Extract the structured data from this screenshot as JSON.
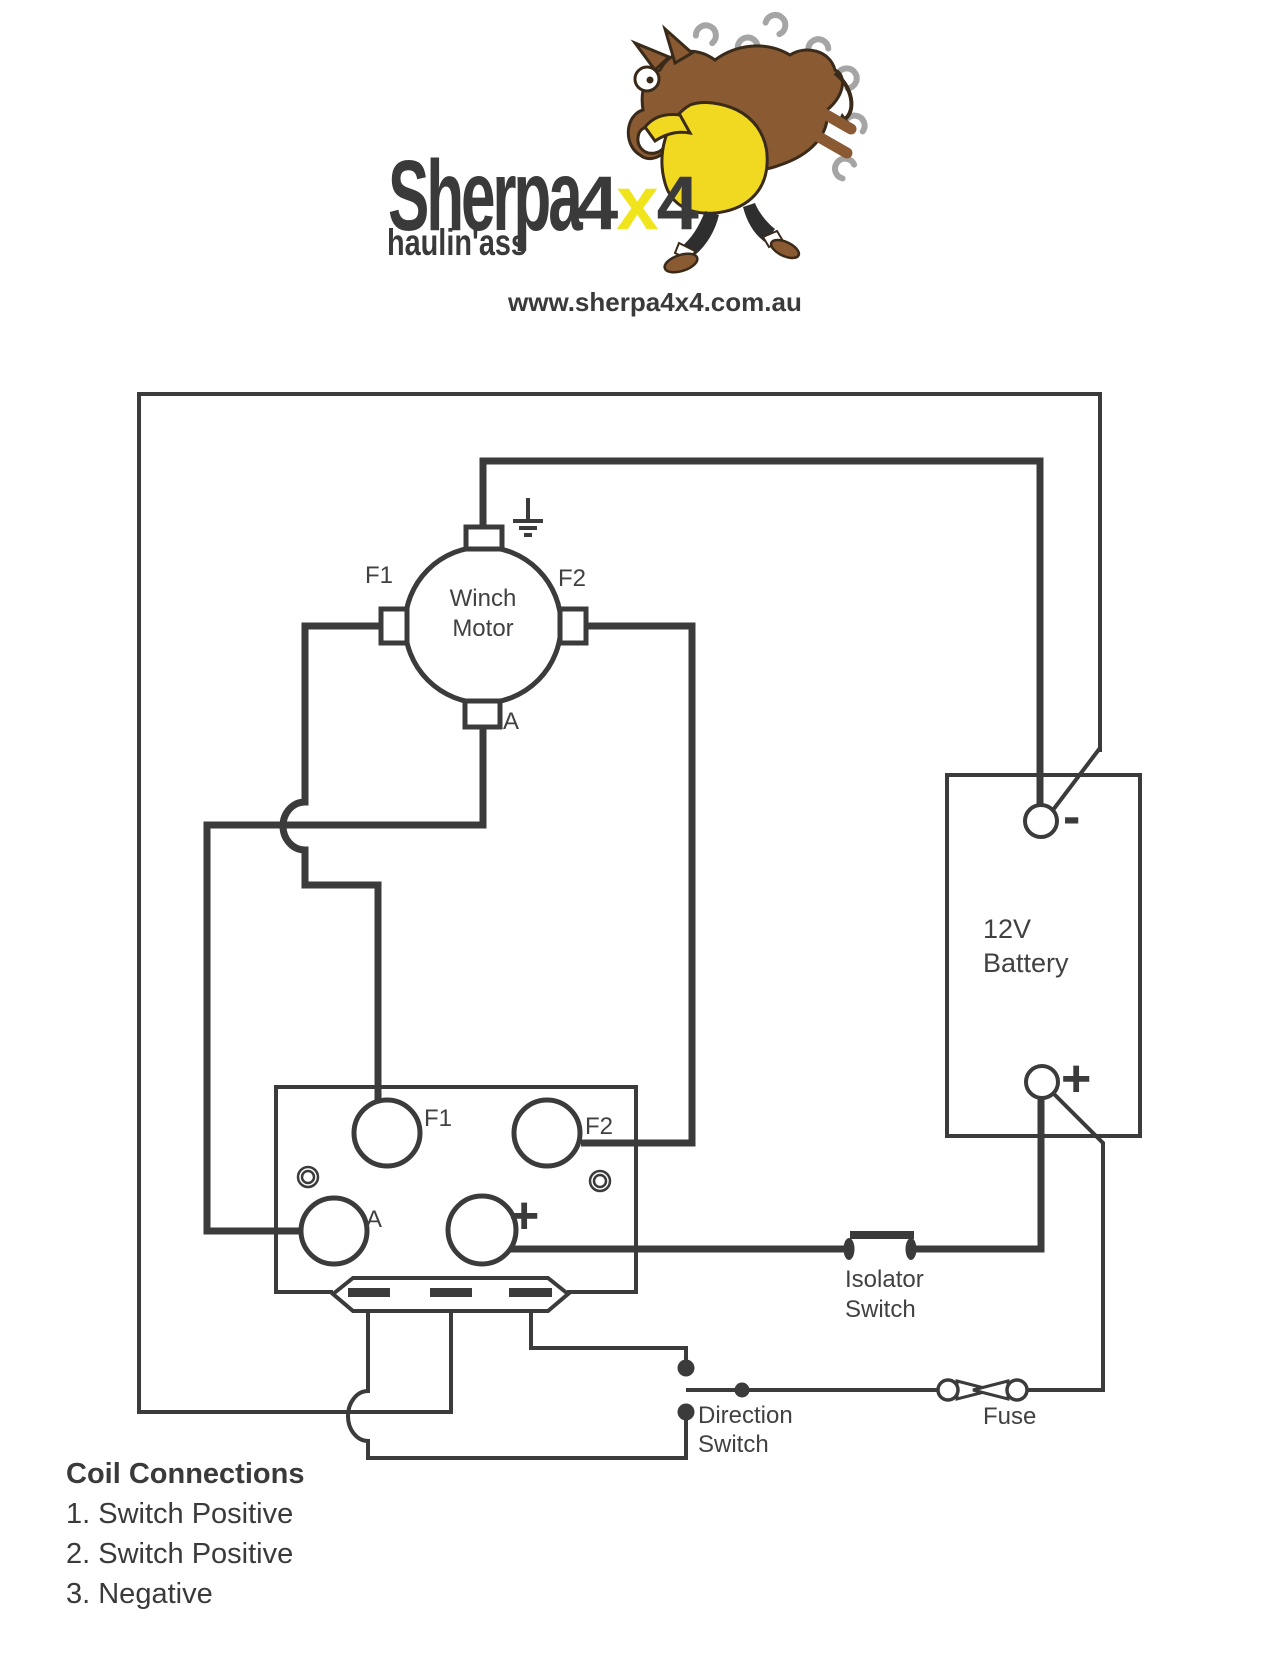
{
  "logo": {
    "brand_main": "Sherpa",
    "brand_suffix": [
      "4",
      "x",
      "4"
    ],
    "tagline": "haulin'ass",
    "website": "www.sherpa4x4.com.au"
  },
  "motor": {
    "name_line1": "Winch",
    "name_line2": "Motor",
    "terminal_f1": "F1",
    "terminal_f2": "F2",
    "terminal_a": "A"
  },
  "solenoid": {
    "terminal_f1": "F1",
    "terminal_f2": "F2",
    "terminal_a": "A",
    "terminal_plus": "+"
  },
  "battery": {
    "label_line1": "12V",
    "label_line2": "Battery",
    "minus_sign": "-",
    "plus_sign": "+"
  },
  "isolator_switch": {
    "label_line1": "Isolator",
    "label_line2": "Switch"
  },
  "direction_switch": {
    "label_line1": "Direction",
    "label_line2": "Switch"
  },
  "fuse": {
    "label": "Fuse"
  },
  "coil_connections": {
    "title": "Coil Connections",
    "items": [
      "1. Switch Positive",
      "2. Switch Positive",
      "3. Negative"
    ]
  },
  "colors": {
    "line": "#3b3b3b",
    "label_text": "#414141",
    "logo_yellow": "#f0e41c",
    "coat_yellow": "#f2d921",
    "donkey_brown": "#8a5a33",
    "horseshoe_gray": "#a5a5a5"
  }
}
